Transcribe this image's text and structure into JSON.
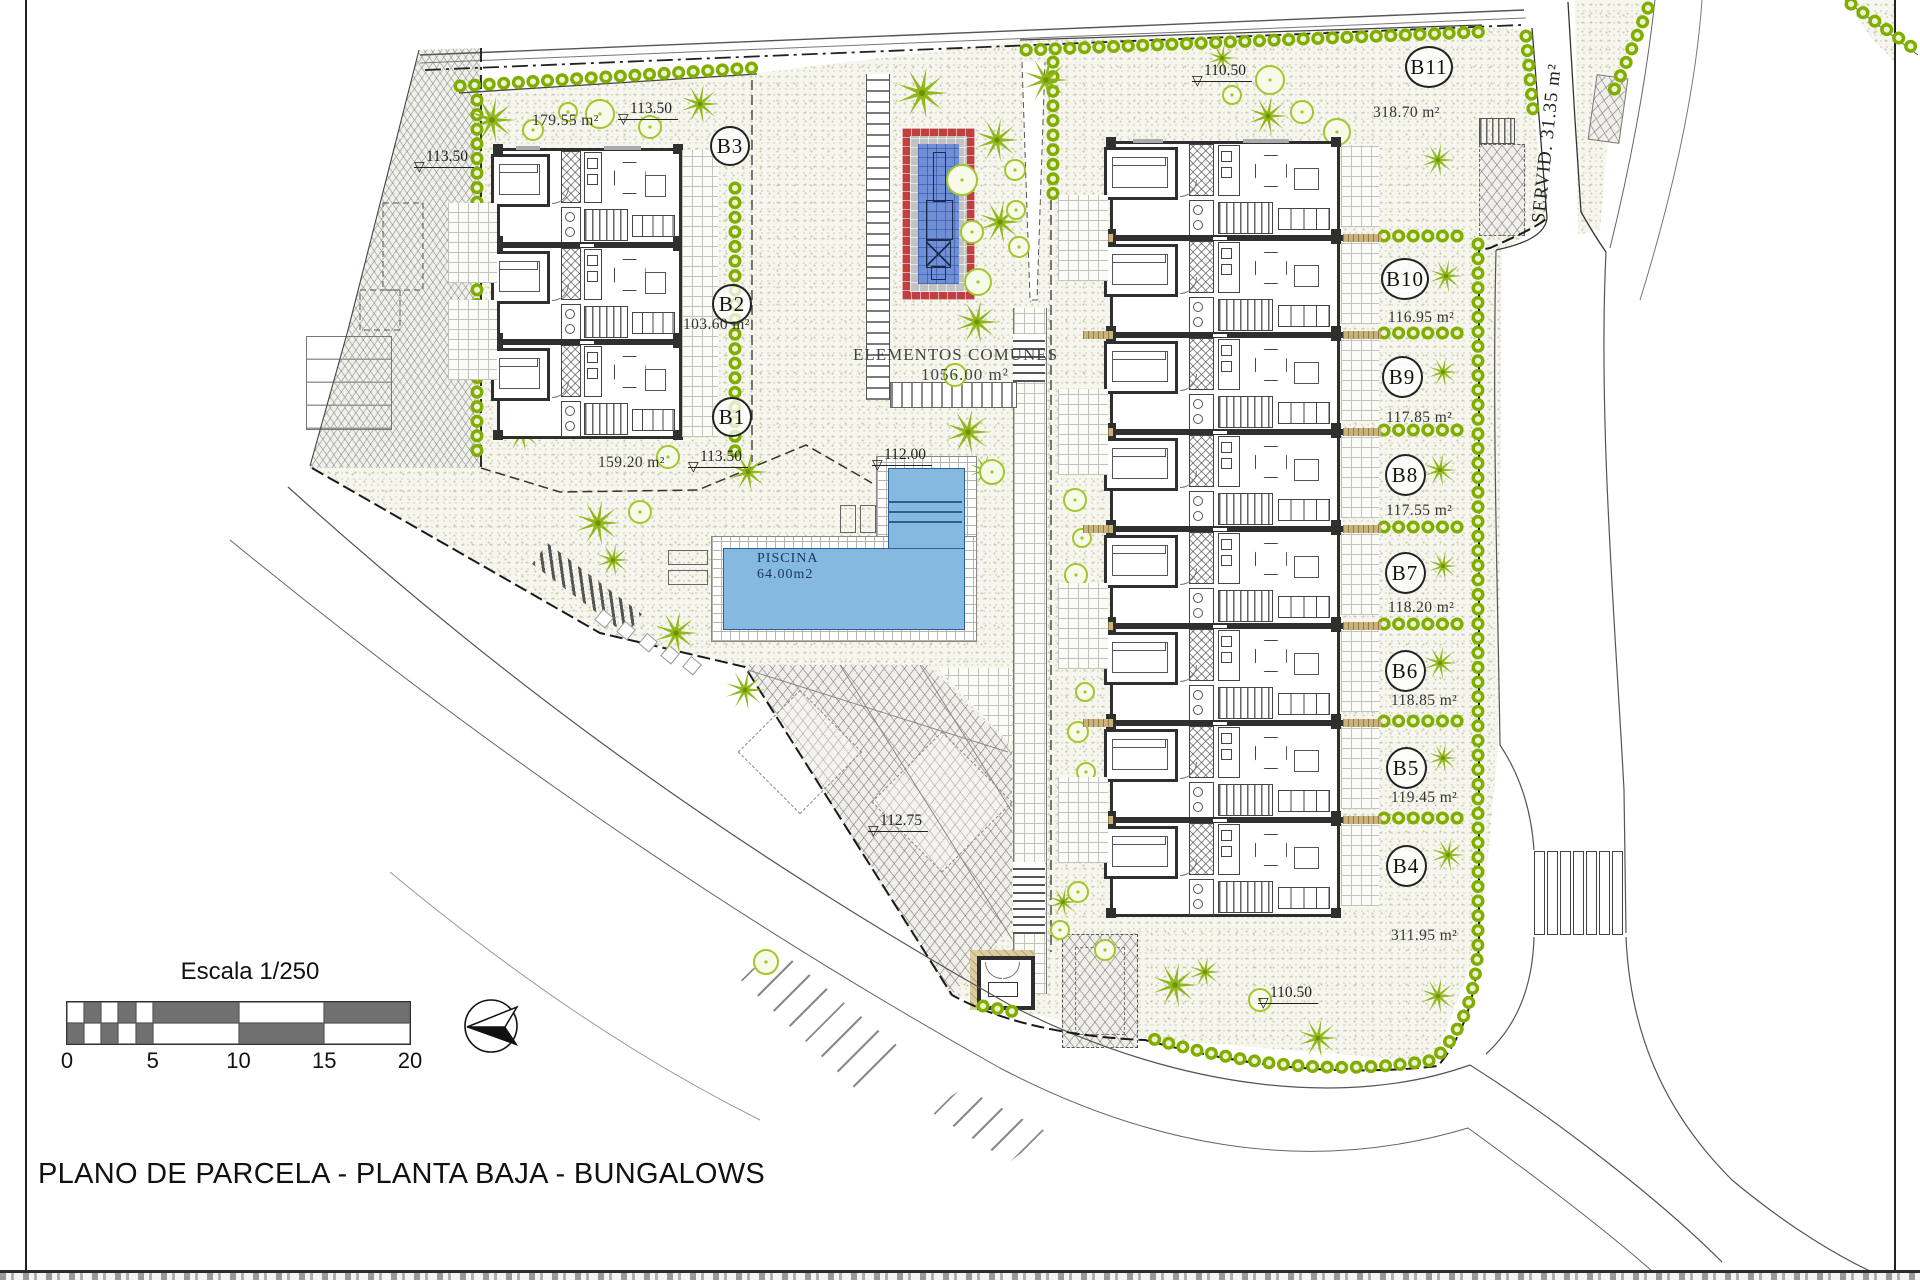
{
  "title_block": {
    "title": "PLANO DE PARCELA - PLANTA BAJA - BUNGALOWS"
  },
  "scale_bar": {
    "label": "Escala 1/250",
    "ticks": [
      "0",
      "5",
      "10",
      "15",
      "20"
    ]
  },
  "common_area": {
    "label": "ELEMENTOS COMUNES",
    "area": "1056.00 m²"
  },
  "pool": {
    "label": "PISCINA",
    "area": "64.00m2"
  },
  "servitude": {
    "label": "SERVID. 31.35 m²"
  },
  "plots_left": [
    {
      "id": "B3",
      "area": "179.55 m²"
    },
    {
      "id": "B2",
      "area": "103.60 m²"
    },
    {
      "id": "B1",
      "area": "159.20 m²"
    }
  ],
  "plots_right": [
    {
      "id": "B11",
      "area": "318.70 m²"
    },
    {
      "id": "B10",
      "area": "116.95 m²"
    },
    {
      "id": "B9",
      "area": "117.85 m²"
    },
    {
      "id": "B8",
      "area": "117.55 m²"
    },
    {
      "id": "B7",
      "area": "118.20 m²"
    },
    {
      "id": "B6",
      "area": "118.85 m²"
    },
    {
      "id": "B5",
      "area": "119.45 m²"
    },
    {
      "id": "B4",
      "area": "311.95 m²"
    }
  ],
  "levels": [
    {
      "value": "113.50"
    },
    {
      "value": "113.50"
    },
    {
      "value": "113.50"
    },
    {
      "value": "112.00"
    },
    {
      "value": "112.75"
    },
    {
      "value": "110.50"
    },
    {
      "value": "110.50"
    }
  ],
  "icons": {
    "north_arrow": "north-compass",
    "palm": "palm-tree",
    "bush": "round-bush"
  }
}
